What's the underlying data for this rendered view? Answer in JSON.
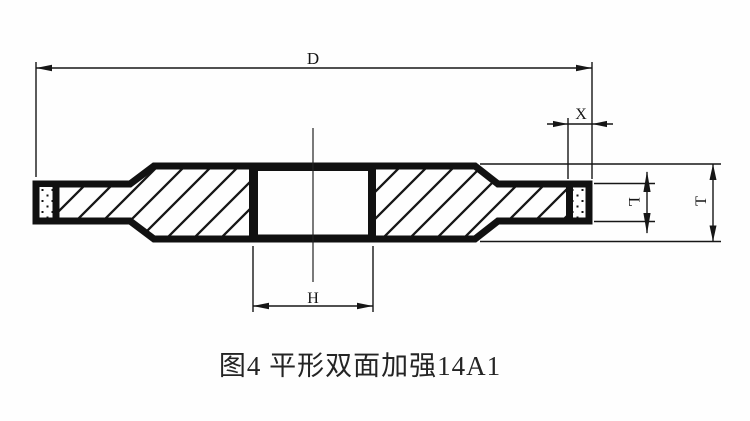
{
  "canvas": {
    "background": "#fefefe",
    "ink_color": "#161616"
  },
  "drawing": {
    "type": "technical-cross-section",
    "subject": "grinding-wheel-14A1-double-side-reinforced",
    "dim_labels": {
      "diameter": "D",
      "abrasive_depth": "X",
      "rim_thickness": "L",
      "total_thickness": "T",
      "bore": "H"
    }
  },
  "caption": {
    "text": "图4 平形双面加强14A1"
  }
}
